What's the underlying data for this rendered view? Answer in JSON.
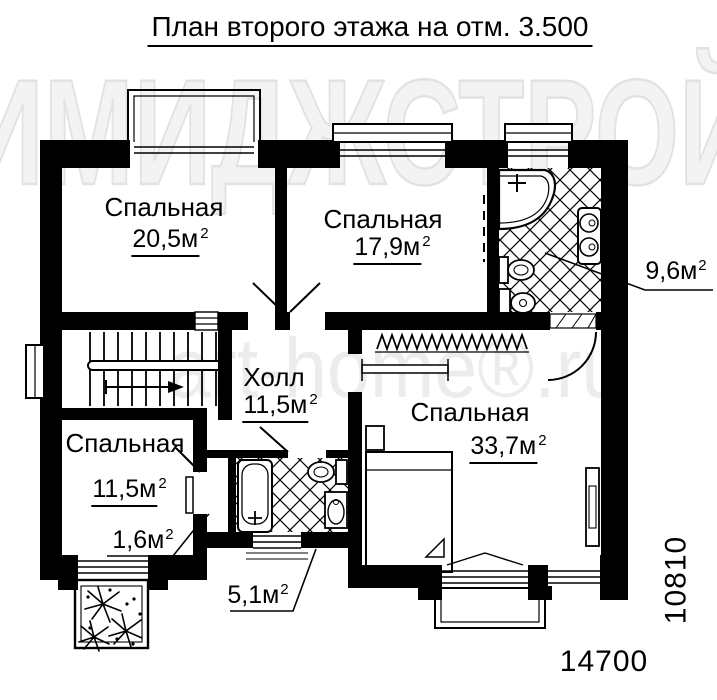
{
  "title": "План второго этажа на отм. 3.500",
  "watermarks": {
    "primary": "ИМИДЖСТРОЙ",
    "secondary": "art-home®.ru"
  },
  "rooms": {
    "bedroom_top_left": {
      "name": "Спальная",
      "area": "20,5м",
      "area_sup": "2"
    },
    "bedroom_top_middle": {
      "name": "Спальная",
      "area": "17,9м",
      "area_sup": "2"
    },
    "bathroom_top": {
      "area": "9,6м",
      "area_sup": "2"
    },
    "hall": {
      "name": "Холл",
      "area": "11,5м",
      "area_sup": "2"
    },
    "bedroom_bottom_left": {
      "name": "Спальная",
      "area": "11,5м",
      "area_sup": "2"
    },
    "closet": {
      "area": "1,6м",
      "area_sup": "2"
    },
    "bathroom_bottom": {
      "area": "5,1м",
      "area_sup": "2"
    },
    "bedroom_bottom_right": {
      "name": "Спальная",
      "area": "33,7м",
      "area_sup": "2"
    }
  },
  "dimensions": {
    "overall_width_mm": "14700",
    "overall_height_mm": "10810"
  }
}
